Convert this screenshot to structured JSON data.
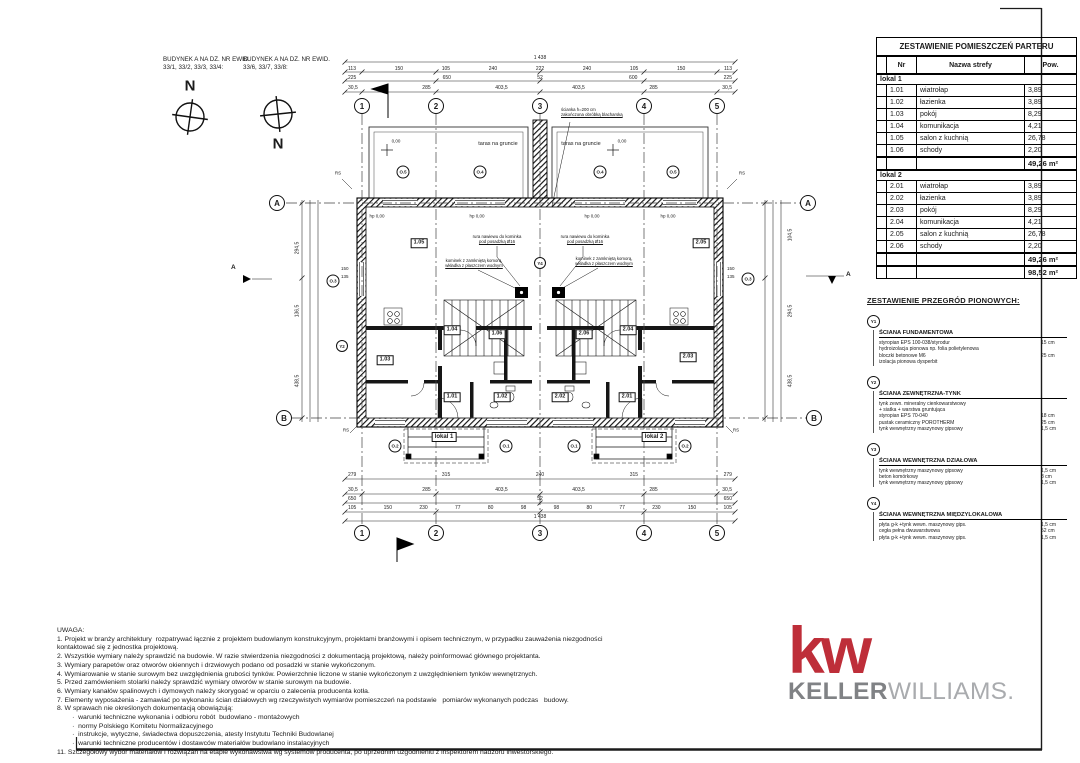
{
  "page": {
    "bg": "#ffffff",
    "ink": "#1b1b1b",
    "accent_red": "#BE2E39",
    "gray_dark": "#808285",
    "gray_light": "#A9ABAE"
  },
  "headers": {
    "b1_line1": "BUDYNEK A NA DZ. NR EWID.",
    "b1_line2": "33/1, 33/2, 33/3, 33/4:",
    "b2_line1": "BUDYNEK A NA DZ. NR EWID.",
    "b2_line2": "33/6, 33/7, 33/8:",
    "north": "N"
  },
  "plan": {
    "grid_cols": [
      "1",
      "2",
      "3",
      "4",
      "5"
    ],
    "grid_rows": [
      "A",
      "B"
    ],
    "section_mark": "A",
    "terrace": "taras na gruncie",
    "level_zero": "0,00",
    "hp": "hp 0,00",
    "lokal1": "lokal 1",
    "lokal2": "lokal 2",
    "rs": "RS",
    "win_top": [
      "O.5",
      "O.4",
      "O.4",
      "O.5"
    ],
    "win_bottom": [
      "O.2",
      "O.1",
      "O.1",
      "O.2"
    ],
    "win_side": "O.3",
    "mark_y2": "Y2",
    "mark_y4": "Y4",
    "side_win_dims": [
      "150",
      "135"
    ],
    "rooms": [
      "1.01",
      "1.02",
      "1.03",
      "1.04",
      "1.05",
      "1.06",
      "2.01",
      "2.02",
      "2.03",
      "2.04",
      "2.05",
      "2.06"
    ],
    "ann": {
      "parapet1": "ścianka h=200 cm",
      "parapet2": "zakończona obróbką blacharską",
      "vent1": "rura nawiewu do kominka",
      "vent2": "pod posadzką Ø16",
      "fire1": "kominek z zamkniętą komorą,",
      "fire2": "wkładka z płaszczem wodnym"
    },
    "dims": {
      "top_total": "1 438",
      "top_r2": [
        "113",
        "150",
        "105",
        "240",
        "222",
        "240",
        "105",
        "150",
        "113"
      ],
      "top_r3": [
        "225",
        "650",
        "52",
        "600",
        "225"
      ],
      "top_r4": [
        "30,5",
        "285",
        "403,5",
        "403,5",
        "285",
        "30,5"
      ],
      "bot_r1": [
        "279",
        "315",
        "240",
        "315",
        "279"
      ],
      "bot_r2": [
        "30,5",
        "285",
        "403,5",
        "403,5",
        "285",
        "30,5"
      ],
      "bot_r3": [
        "650",
        "52",
        "650"
      ],
      "bot_r4": [
        "105",
        "150",
        "230",
        "77",
        "80",
        "98",
        "98",
        "80",
        "77",
        "230",
        "150",
        "105"
      ],
      "bot_total": "1 438",
      "left": [
        "294,5",
        "136,5",
        "438,5"
      ],
      "right": [
        "104,5",
        "294,5",
        "438,5"
      ]
    }
  },
  "rooms_table": {
    "title": "ZESTAWIENIE POMIESZCZEŃ PARTERU",
    "col_nr": "Nr",
    "col_name": "Nazwa strefy",
    "col_area": "Pow.",
    "group1": "lokal 1",
    "g1": [
      [
        "1.01",
        "wiatrołap",
        "3,89"
      ],
      [
        "1.02",
        "łazienka",
        "3,89"
      ],
      [
        "1.03",
        "pokój",
        "8,29"
      ],
      [
        "1.04",
        "komunikacja",
        "4,21"
      ],
      [
        "1.05",
        "salon z kuchnią",
        "26,78"
      ],
      [
        "1.06",
        "schody",
        "2,20"
      ]
    ],
    "g1_sum": "49,26 m²",
    "group2": "lokal 2",
    "g2": [
      [
        "2.01",
        "wiatrołap",
        "3,89"
      ],
      [
        "2.02",
        "łazienka",
        "3,89"
      ],
      [
        "2.03",
        "pokój",
        "8,29"
      ],
      [
        "2.04",
        "komunikacja",
        "4,21"
      ],
      [
        "2.05",
        "salon z kuchnią",
        "26,78"
      ],
      [
        "2.06",
        "schody",
        "2,20"
      ]
    ],
    "g2_sum": "49,26 m²",
    "total": "98,52 m²"
  },
  "partitions": {
    "title": "ZESTAWIENIE PRZEGRÓD PIONOWYCH:",
    "items": [
      {
        "mark": "Y1",
        "name": "ŚCIANA FUNDAMENTOWA",
        "layers": [
          [
            "styropian EPS 100-038/styrodur",
            "15 cm"
          ],
          [
            "hydroizolacja pionowa np. folia polietylenowa",
            ""
          ],
          [
            "bloczki betonowe M6",
            "25 cm"
          ],
          [
            "izolacja pionowa dysperbit",
            ""
          ]
        ]
      },
      {
        "mark": "Y2",
        "name": "ŚCIANA ZEWNĘTRZNA-TYNK",
        "layers": [
          [
            "tynk zewn. mineralny cienkowarstwowy",
            ""
          ],
          [
            "+ siatka + warstwa gruntująca",
            ""
          ],
          [
            "styropian EPS 70-040",
            "18 cm"
          ],
          [
            "pustak ceramiczny POROTHERM",
            "25 cm"
          ],
          [
            "tynk wewnętrzny maszynowy gipsowy",
            "1,5 cm"
          ]
        ]
      },
      {
        "mark": "Y3",
        "name": "ŚCIANA WEWNĘTRZNA DZIAŁOWA",
        "layers": [
          [
            "tynk wewnętrzny maszynowy gipsowy",
            "1,5 cm"
          ],
          [
            "beton komórkowy",
            "8 cm"
          ],
          [
            "tynk wewnętrzny maszynowy gipsowy",
            "1,5 cm"
          ]
        ]
      },
      {
        "mark": "Y4",
        "name": "ŚCIANA WEWNĘTRZNA MIĘDZYLOKALOWA",
        "layers": [
          [
            "płyta g-k +tynk wewn. maszynowy gips.",
            "1,5 cm"
          ],
          [
            "cegła pełna dwuwarstwowa",
            "52 cm"
          ],
          [
            "płyta g-k +tynk wewn. maszynowy gips.",
            "1,5 cm"
          ]
        ]
      }
    ]
  },
  "notes": {
    "title": "UWAGA:",
    "lines": [
      "1. Projekt w branży architektury  rozpatrywać łącznie z projektem budowlanym konstrukcyjnym, projektami branżowymi i opisem technicznym, w przypadku zauważenia niezgodności",
      "kontaktować się z jednostka projektową.",
      "2. Wszystkie wymiary należy sprawdzić na budowie. W razie stwierdzenia niezgodności z dokumentacją projektową, należy poinformować głównego projektanta.",
      "3. Wymiary parapetów oraz otworów okiennych i drzwiowych podano od posadzki w stanie wykończonym.",
      "4. Wymiarowanie w stanie surowym bez uwzględnienia grubości tynków. Powierzchnie liczone w stanie wykończonym z uwzględnieniem tynków wewnętrznych.",
      "5. Przed zamówieniem stolarki należy sprawdzić wymiary otworów w stanie surowym na budowie.",
      "6. Wymiary kanałów spalinowych i dymowych należy skorygoać w oparciu o zalecenia producenta kotła.",
      "7. Elementy wyposażenia - zamawiać po wykonaniu ścian działowych wg rzeczywistych wymiarów pomieszczeń na podstawie   pomiarów wykonanych podczas   budowy.",
      "8. W sprawach nie określonych dokumentacją obowiązują:",
      "        ·  warunki techniczne wykonania i odbioru robót  budowlano - montażowych",
      "        ·  normy Polskiego Komitetu Normalizacyjnego",
      "        ·  instrukcje, wytyczne, świadectwa dopuszczenia, atesty Instytutu Techniki Budowlanej",
      "        ·  warunki techniczne producentów i dostawców materiałów budowlano instalacyjnych",
      "11. Szczegółowy wybór materiałów i rozwiązań na etapie wykonawstwa wg systemów producenta, po uprzednim uzgodnieniu z inspektorem nadzoru inwestorskiego."
    ]
  },
  "logo": {
    "kw": "kw",
    "keller": "KELLER",
    "williams": "WILLIAMS."
  }
}
